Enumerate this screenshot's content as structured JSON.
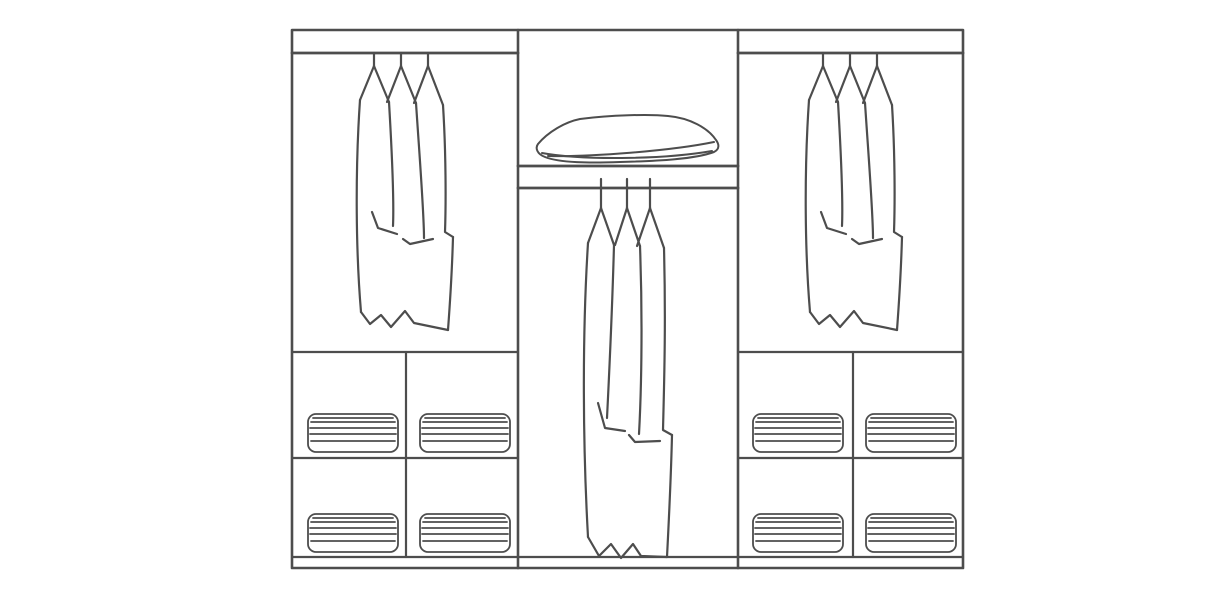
{
  "diagram": {
    "label": "Wardrobe interior elevation line drawing",
    "type": "line-drawing",
    "sections": [
      {
        "id": "left-bay",
        "top": "hanging rail with three garments",
        "bottom": "four cubbies, each with a stack of folded linen"
      },
      {
        "id": "middle-bay",
        "top": "shelf with a pillow",
        "bottom": "full-height hanging rail with three long garments"
      },
      {
        "id": "right-bay",
        "top": "hanging rail with three garments",
        "bottom": "four cubbies, each with a stack of folded linen"
      }
    ],
    "garments_per_rail": 3,
    "linen_stacks_total": 8
  },
  "colors": {
    "background": "#ffffff",
    "line": "#4d4d4d"
  }
}
